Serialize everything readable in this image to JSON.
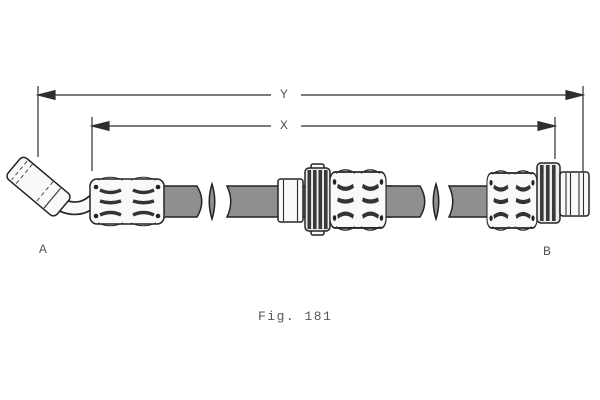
{
  "figure": {
    "caption": "Fig. 181",
    "labels": {
      "dimension_y": "Y",
      "dimension_x": "X",
      "end_a": "A",
      "end_b": "B"
    }
  },
  "colors": {
    "background": "#ffffff",
    "line": "#2e2e2e",
    "hose": "#8f8f8f",
    "fitting": "#f9f9f9",
    "ring_band": "#3a3a3a",
    "text": "#565656"
  }
}
